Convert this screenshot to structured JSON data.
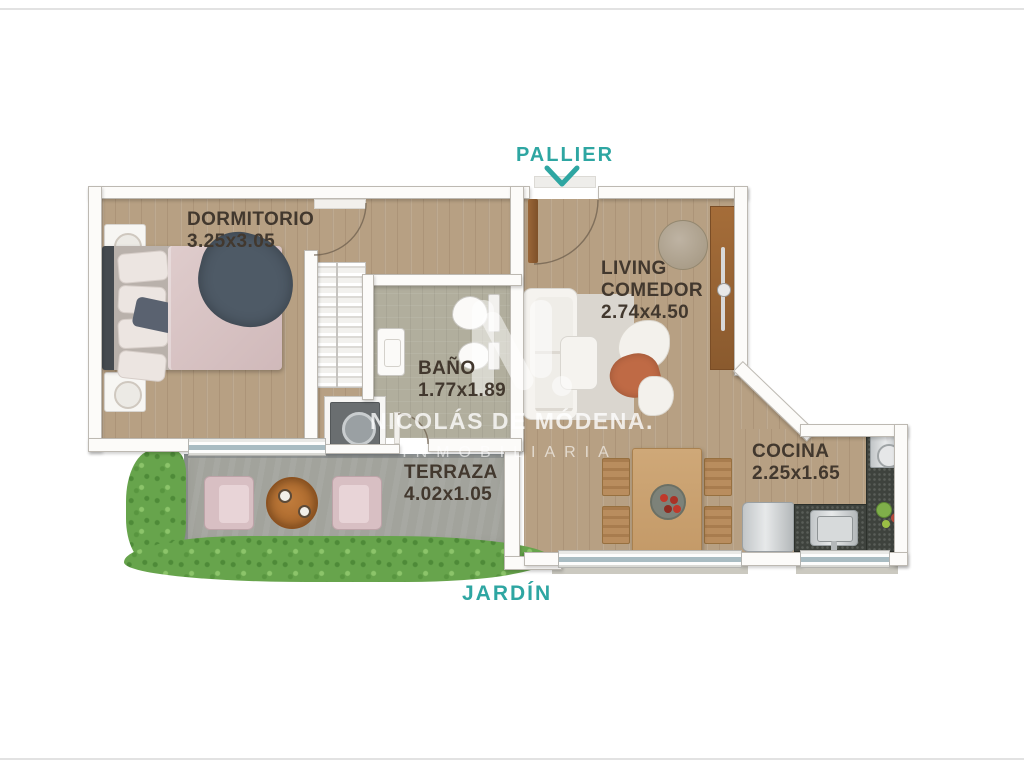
{
  "plan": {
    "labels": {
      "pallier": "PALLIER",
      "jardin": "JARDÍN"
    },
    "rooms": {
      "dormitorio": {
        "name": "DORMITORIO",
        "dims": "3.25x3.05"
      },
      "bano": {
        "name": "BAÑO",
        "dims": "1.77x1.89"
      },
      "living": {
        "line1": "LIVING",
        "line2": "COMEDOR",
        "dims": "2.74x4.50"
      },
      "cocina": {
        "name": "COCINA",
        "dims": "2.25x1.65"
      },
      "terraza": {
        "name": "TERRAZA",
        "dims": "4.02x1.05"
      }
    },
    "watermark": {
      "brand": "NICOLÁS DE MÓDENA.",
      "tagline": "INMOBILIARIA"
    },
    "colors": {
      "accent_teal": "#2ea6a2",
      "label_dark": "#42382e",
      "wood_floor": "#b7a083",
      "bath_floor": "#b1ae9d",
      "terrace_floor": "#a2a39c",
      "grass_green": "#67a44c",
      "counter_granite": "#3e423d",
      "door_wood": "#8a5c33"
    }
  }
}
